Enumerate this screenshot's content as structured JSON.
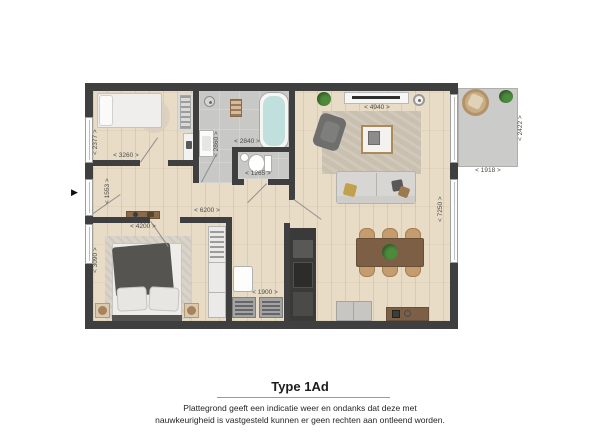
{
  "footer": {
    "title": "Type 1Ad",
    "disclaimer_line1": "Plattegrond geeft een indicatie weer en ondanks dat deze met",
    "disclaimer_line2": "nauwkeurigheid is vastgesteld kunnen er geen rechten aan ontleend worden."
  },
  "dims": {
    "bedroom2_depth": "< 2377 >",
    "bedroom2_width": "< 3260 >",
    "bathroom_width": "< 2840 >",
    "bathroom_depth": "< 2860 >",
    "toilet_width": "< 1265 >",
    "hall_width": "< 6200 >",
    "hall_depth": "< 1553 >",
    "master_bedroom_width": "< 4200 >",
    "master_bedroom_depth": "< 3090 >",
    "laundry_width": "< 1900 >",
    "living_room_width": "< 4940 >",
    "living_room_depth": "< 7250 >",
    "terrace_width": "< 1918 >",
    "terrace_depth": "< 2422 >"
  },
  "icons": {
    "entrance_arrow": "▶"
  },
  "colors": {
    "wall": "#3f3f3f",
    "wood_floor": "#e8dcc7",
    "tile_floor": "#c8c8c6",
    "terrace_floor": "#cbcbc9",
    "bathtub": "#bfe0dd",
    "dining_table": "#7d5f46",
    "chair_wicker": "#c49c6e",
    "plant": "#4c8b3c"
  }
}
